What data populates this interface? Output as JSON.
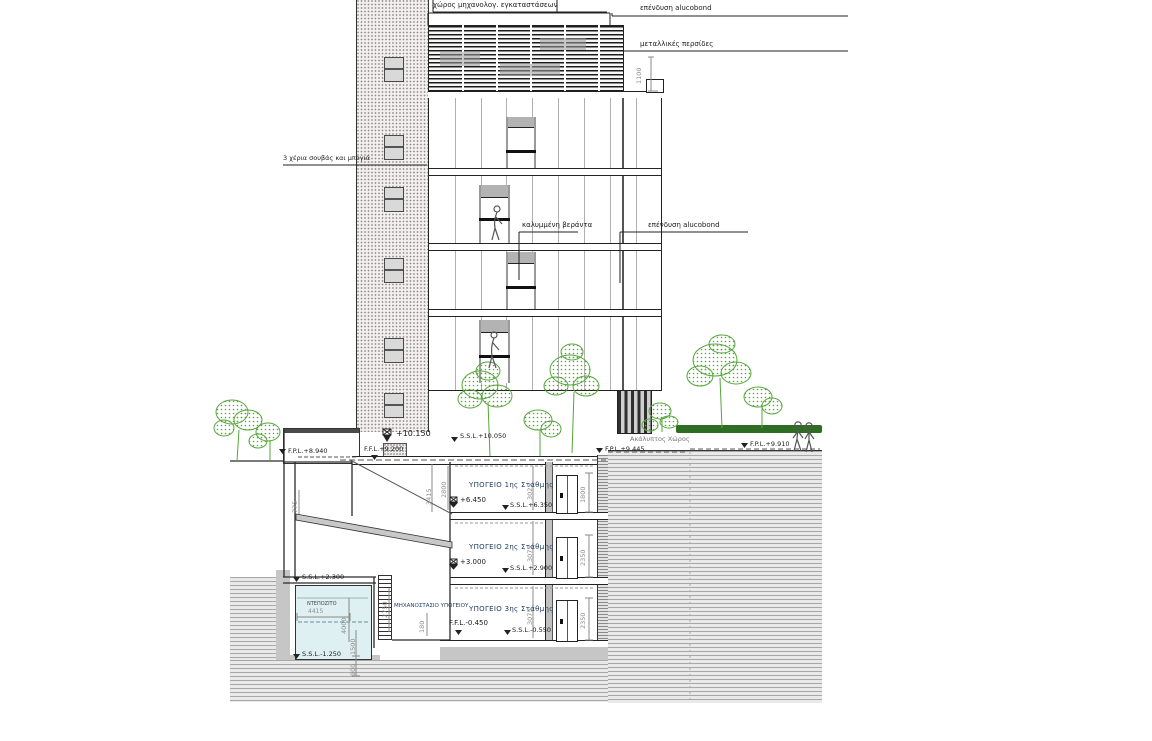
{
  "drawing": {
    "annotations": {
      "roof_space": "χώρος μηχανολογ. εγκαταστάσεων",
      "alucobond_top": "επένδυση alucobond",
      "metal_louvers": "μεταλλικές περσίδες",
      "plaster": "3 χέρια σουβάς και μπογιά",
      "covered_veranda": "καλυμμένη βεράντα",
      "alucobond_mid": "επένδυση alucobond",
      "open_space": "Ακάλυπτος Χώρος",
      "basement1": "ΥΠΟΓΕΙΟ 1ης Στάθμης",
      "basement2": "ΥΠΟΓΕΙΟ 2ης Στάθμης",
      "basement3": "ΥΠΟΓΕΙΟ 3ης Στάθμης",
      "machine_room": "ΜΗΧΑΝΟΣΤΑΣΙΟ ΥΠΟΓΕΙΟΥ",
      "water_tank": "ΝΤΕΠΟΖΙΤΟ"
    },
    "levels": {
      "street_ffl": "+10.150",
      "street_ssl": "S.S.L.+10.050",
      "ffl_9200": "F.F.L.+9.200",
      "fpl_8940": "F.P.L.+8.940",
      "fpl_9445": "F.P.L.+9.445",
      "fpl_9910": "F.P.L.+9.910",
      "b1_ffl": "+6.450",
      "b1_ssl": "S.S.L.+6.350",
      "b2_ffl": "+3.000",
      "b2_ssl": "S.S.L.+2.900",
      "b3_ffl": "F.F.L.-0.450",
      "b3_ssl": "S.S.L.-0.550",
      "ramp_ssl": "S.S.L.+2.300",
      "tank_ssl": "S.S.L.-1.250"
    },
    "dimensions": {
      "louver_height": "1100",
      "b1_left": "2800",
      "b1_mid": "3025",
      "b2_mid": "3075",
      "b3_mid": "3075",
      "door1": "1800",
      "door2": "2350",
      "door3": "2350",
      "ladder": "2750",
      "mech": "180",
      "ramp": "3415",
      "ramp_left": "775",
      "tank_width": "4415",
      "tank_depth": "4000",
      "tank_lower": "1500",
      "tank_base": "900"
    },
    "colors": {
      "line": "#2b2b2b",
      "dim_text": "#8f8f8f",
      "tree_green": "#55a63a",
      "hedge_green": "#2f6d25",
      "pool_blue": "#dff0f2",
      "earth_gray": "#c9c9c9",
      "room_label": "#1d3a5f"
    }
  }
}
